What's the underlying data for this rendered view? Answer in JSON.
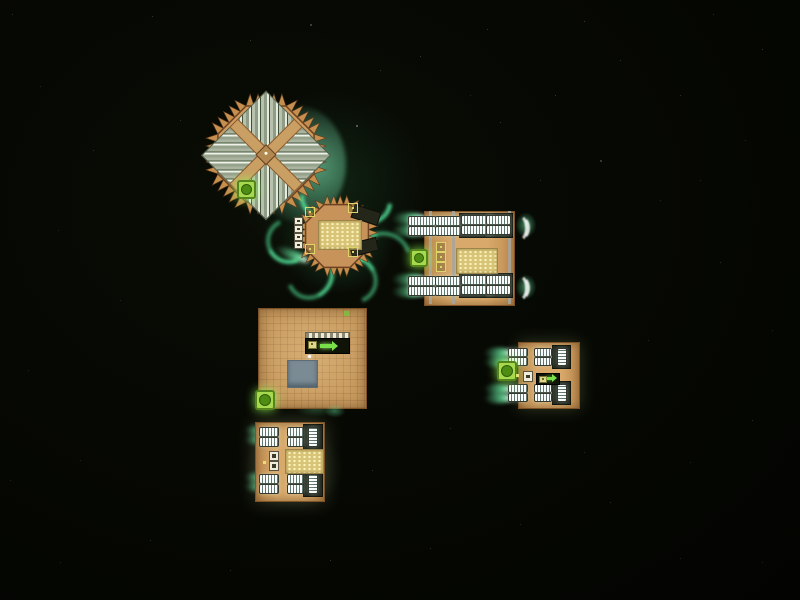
{
  "scene": {
    "title": "space-battle-viewport",
    "background": {
      "base": "#060803",
      "vignette_center": "#0a0d05"
    },
    "palette": {
      "hull_tan": "#d8a96b",
      "hull_outline": "#7d5227",
      "spike": "#c68f4e",
      "exhaust_green": "#6ef5aa",
      "engine_teal": "#9fd4c8",
      "cargo_yellow": "#d8c478",
      "reactor_green": "#a6d94e",
      "reactor_core": "#4e8c14",
      "beam_gray": "#a6a69d",
      "armor_stripe_dark": "#3f5138",
      "armor_stripe_light": "#e6ebe0"
    },
    "stars": [
      [
        12,
        14,
        1,
        0.25
      ],
      [
        152,
        16,
        1,
        0.3
      ],
      [
        310,
        24,
        2,
        0.35
      ],
      [
        356,
        125,
        2,
        0.5
      ],
      [
        420,
        56,
        1,
        0.3
      ],
      [
        487,
        29,
        1,
        0.3
      ],
      [
        584,
        21,
        1,
        0.3
      ],
      [
        713,
        14,
        1,
        0.25
      ],
      [
        762,
        49,
        1,
        0.3
      ],
      [
        40,
        86,
        1,
        0.2
      ],
      [
        93,
        150,
        1,
        0.25
      ],
      [
        680,
        95,
        1,
        0.25
      ],
      [
        745,
        140,
        1,
        0.2
      ],
      [
        620,
        60,
        1,
        0.25
      ],
      [
        555,
        95,
        1,
        0.3
      ],
      [
        58,
        230,
        1,
        0.2
      ],
      [
        120,
        300,
        1,
        0.2
      ],
      [
        28,
        370,
        1,
        0.2
      ],
      [
        80,
        460,
        1,
        0.2
      ],
      [
        150,
        540,
        1,
        0.25
      ],
      [
        230,
        570,
        1,
        0.25
      ],
      [
        330,
        560,
        1,
        0.3
      ],
      [
        430,
        548,
        1,
        0.25
      ],
      [
        520,
        524,
        1,
        0.2
      ],
      [
        610,
        502,
        1,
        0.25
      ],
      [
        690,
        462,
        1,
        0.2
      ],
      [
        752,
        420,
        1,
        0.25
      ],
      [
        772,
        330,
        1,
        0.2
      ],
      [
        720,
        262,
        1,
        0.25
      ],
      [
        660,
        200,
        1,
        0.2
      ],
      [
        600,
        160,
        2,
        0.3
      ],
      [
        500,
        122,
        1,
        0.3
      ],
      [
        380,
        70,
        1,
        0.3
      ],
      [
        250,
        40,
        1,
        0.3
      ],
      [
        180,
        120,
        1,
        0.25
      ],
      [
        680,
        558,
        1,
        0.2
      ],
      [
        762,
        562,
        1,
        0.2
      ],
      [
        60,
        562,
        1,
        0.2
      ],
      [
        10,
        480,
        1,
        0.2
      ],
      [
        372,
        470,
        1,
        0.3
      ],
      [
        450,
        428,
        1,
        0.25
      ],
      [
        584,
        452,
        1,
        0.2
      ],
      [
        648,
        340,
        1,
        0.2
      ],
      [
        700,
        180,
        1,
        0.2
      ],
      [
        540,
        180,
        1,
        0.25
      ],
      [
        470,
        95,
        1,
        0.2
      ]
    ],
    "ships": [
      {
        "id": "spiked-flagship",
        "type": "octagonal battleship",
        "rect": {
          "x": 192,
          "y": 80,
          "w": 148,
          "h": 148
        },
        "spike_params": {
          "cx": 74,
          "cy": 74,
          "body_r": 52,
          "spike_len": 12,
          "per_edge": 5,
          "hull_fill": "#cf9b5e",
          "hull_stroke": "#6e4322",
          "spike_fill": "#c68f4e",
          "spike_stroke": "#5e3a1c"
        },
        "modules": [
          "armor-panels",
          "structural-cross",
          "command-core",
          "reactor"
        ]
      },
      {
        "id": "spiked-corvette",
        "type": "spiked corvette with engine trails",
        "rect": {
          "x": 282,
          "y": 190,
          "w": 108,
          "h": 100
        },
        "spike_params": {
          "cx": 55,
          "cy": 46,
          "body_r": 34,
          "spike_len": 9,
          "per_edge": 4,
          "hull_fill": "#c8935a",
          "hull_stroke": "#6e4322",
          "spike_fill": "#c68f4e",
          "spike_stroke": "#5e3a1c"
        },
        "modules": [
          "crate-grid",
          "thruster-boxes",
          "dark-wings"
        ]
      },
      {
        "id": "heavy-freighter",
        "type": "large freighter",
        "rect": {
          "x": 398,
          "y": 198,
          "w": 140,
          "h": 118
        },
        "modules": [
          "engine-banks-top",
          "engine-banks-bottom",
          "reactor",
          "crate-grid",
          "loader-boxes",
          "structural-beams"
        ]
      },
      {
        "id": "cargo-platform",
        "type": "square cargo platform",
        "rect": {
          "x": 258,
          "y": 308,
          "w": 107,
          "h": 99
        },
        "modules": [
          "conveyor-loader",
          "gray-pad",
          "reactor"
        ]
      },
      {
        "id": "freighter-east",
        "type": "small freighter",
        "rect": {
          "x": 488,
          "y": 336,
          "w": 104,
          "h": 78
        },
        "modules": [
          "engine-banks",
          "reactor",
          "loader"
        ]
      },
      {
        "id": "freighter-south",
        "type": "small freighter",
        "rect": {
          "x": 243,
          "y": 410,
          "w": 100,
          "h": 100
        },
        "modules": [
          "engine-banks",
          "crate-grid",
          "supply-boxes"
        ]
      }
    ]
  }
}
